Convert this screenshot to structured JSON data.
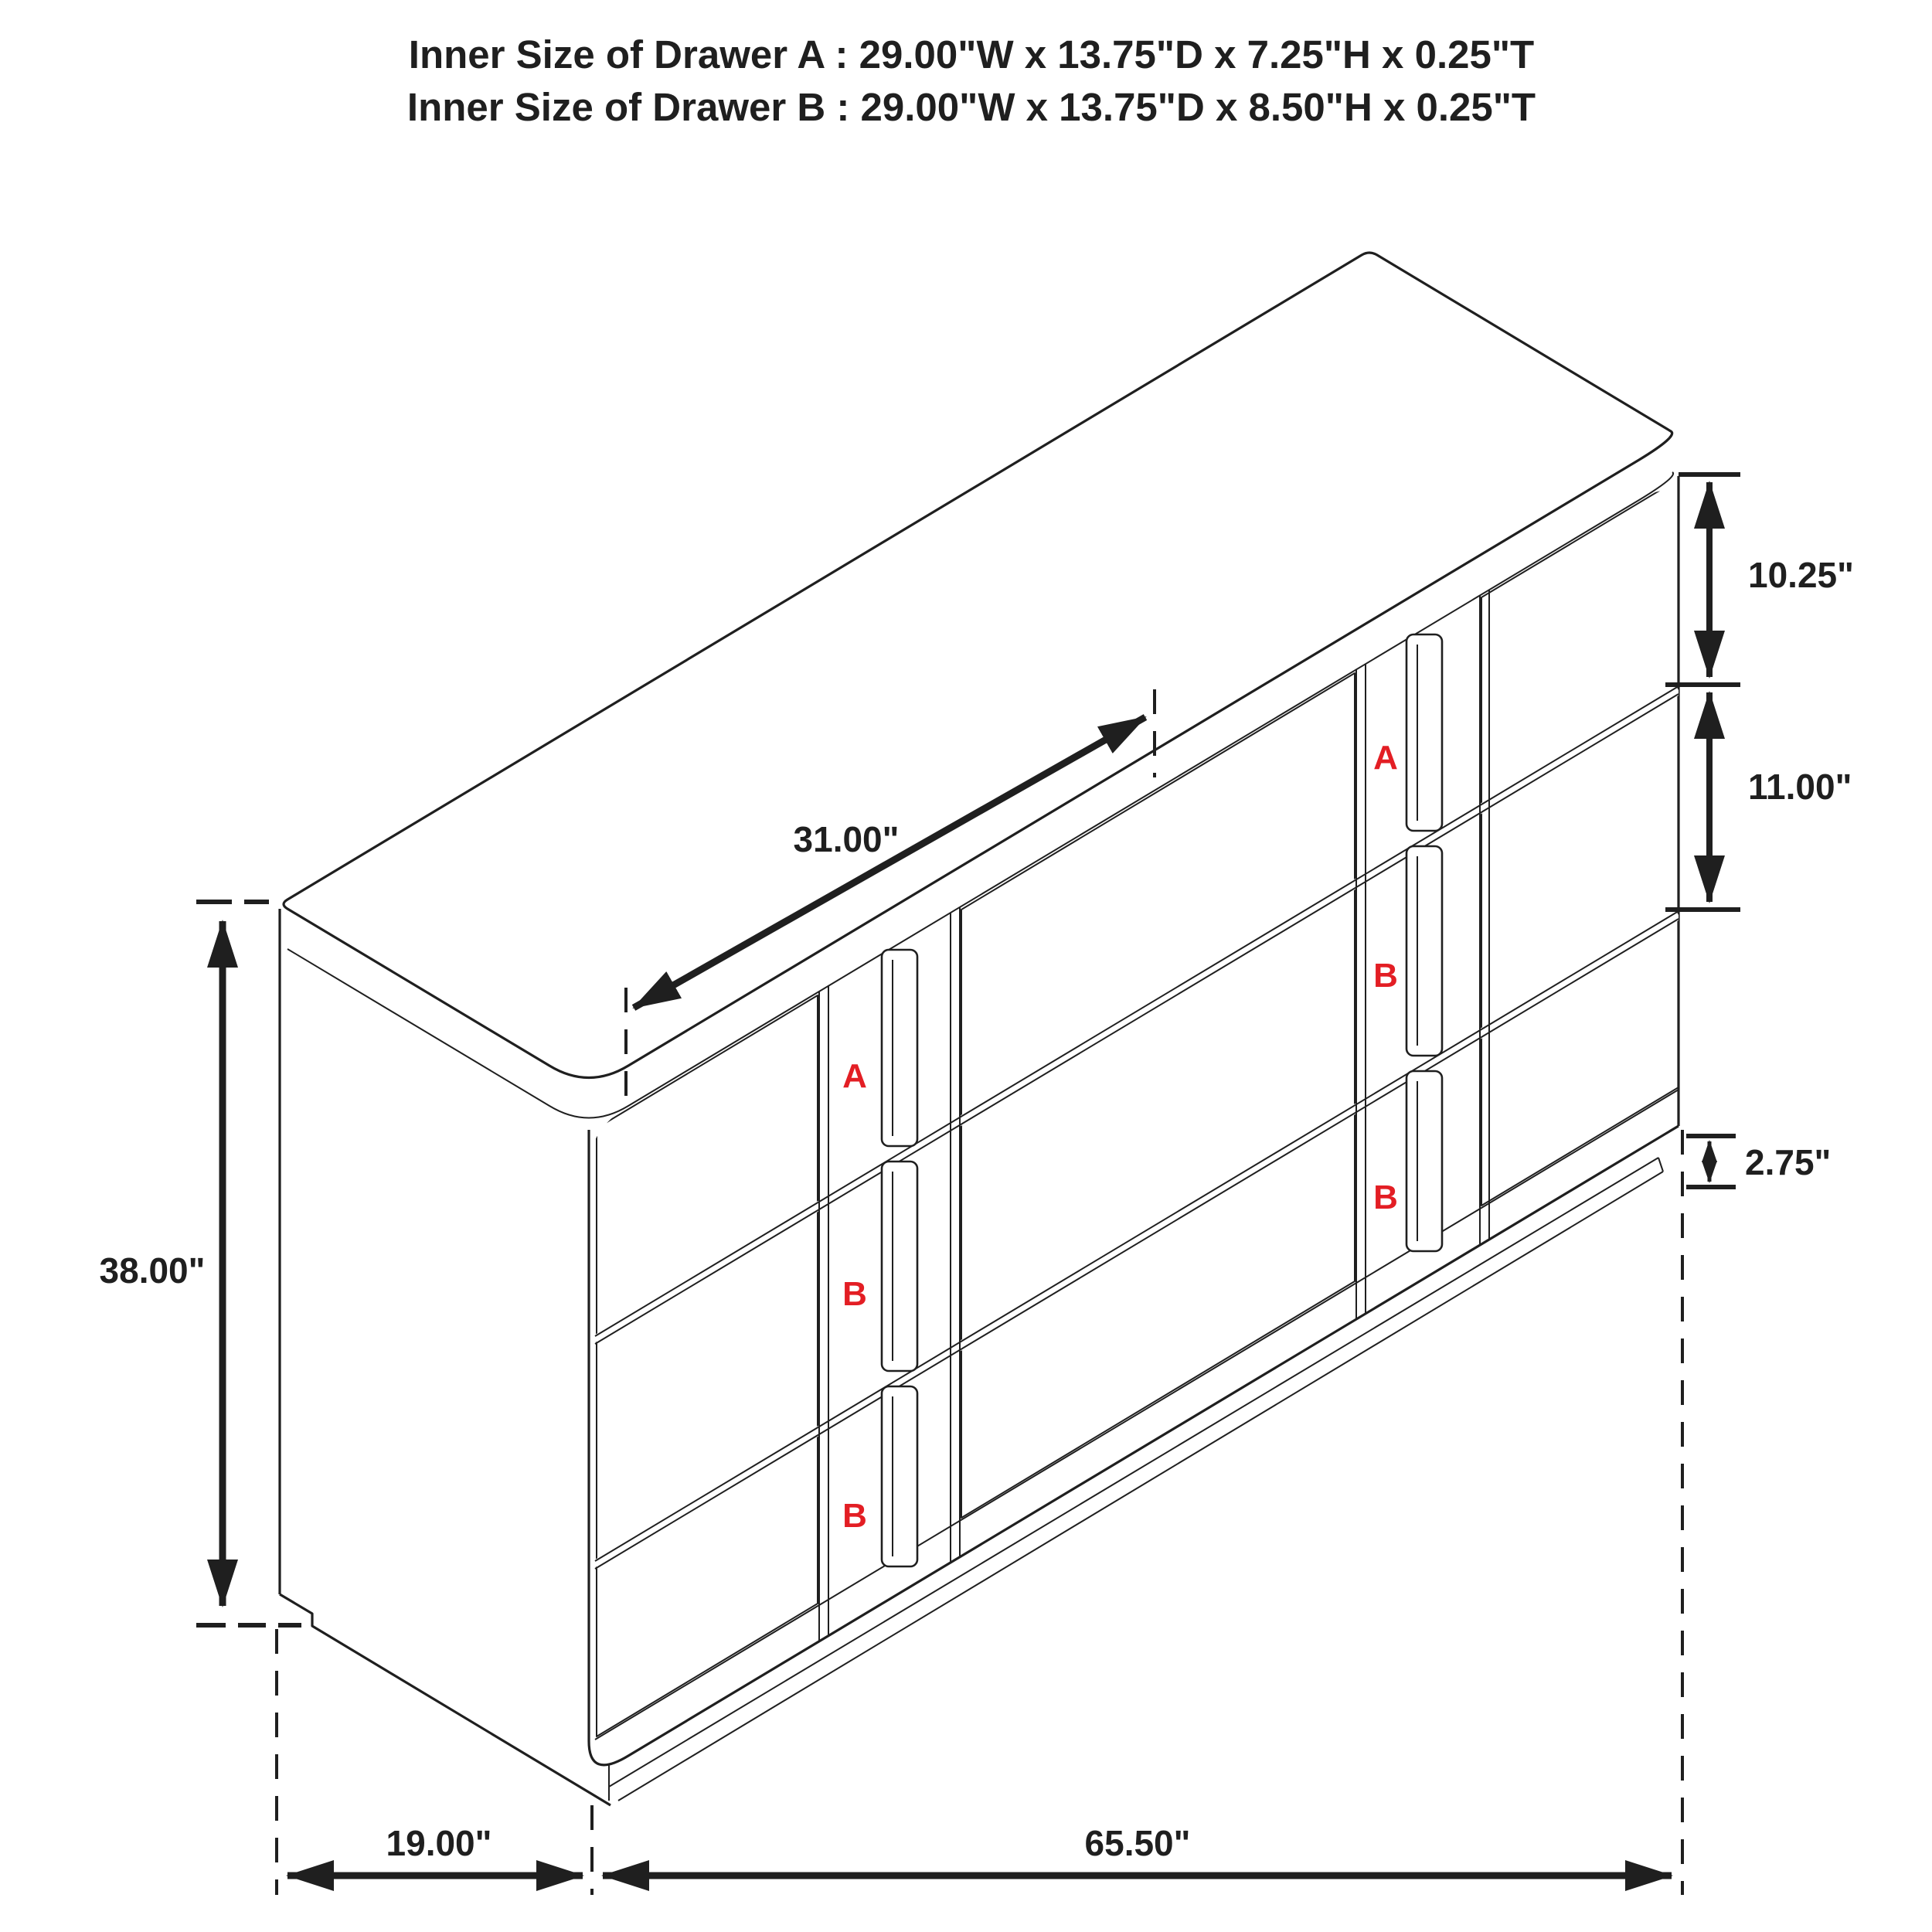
{
  "title": {
    "line1": "Inner Size of Drawer A : 29.00\"W x 13.75\"D x 7.25\"H x 0.25\"T",
    "line2": "Inner Size of Drawer B : 29.00\"W x 13.75\"D x 8.50\"H x 0.25\"T"
  },
  "dimensions": {
    "overall_height": "38.00\"",
    "top_drawer_front": "10.25\"",
    "lower_drawer_front": "11.00\"",
    "base_height": "2.75\"",
    "center_section_width": "31.00\"",
    "overall_depth": "19.00\"",
    "overall_width": "65.50\""
  },
  "drawer_labels": {
    "left_bank": [
      "A",
      "B",
      "B"
    ],
    "right_bank": [
      "A",
      "B",
      "B"
    ]
  },
  "colors": {
    "line": "#1f1f1f",
    "label_red": "#e31e24",
    "background": "#ffffff"
  }
}
